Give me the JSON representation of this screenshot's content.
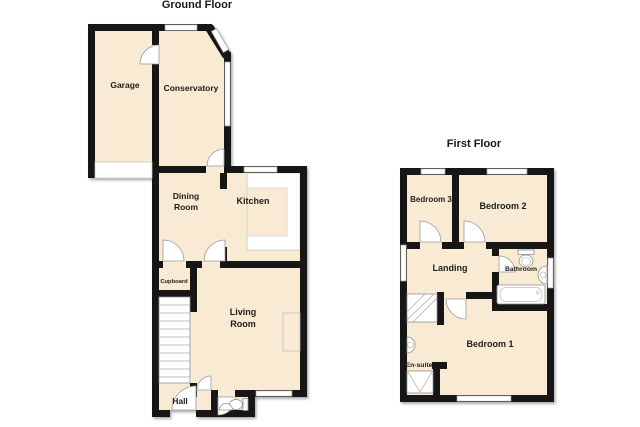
{
  "page": {
    "background": "#ffffff"
  },
  "colors": {
    "room_fill": "#f8ead3",
    "wall": "#161616",
    "window_fill": "#ffffff",
    "window_stroke": "#999999",
    "fixture_stroke": "#909090",
    "label_text": "#1d1d1d"
  },
  "ground_floor": {
    "title": "Ground Floor",
    "rooms": {
      "garage": {
        "label": "Garage"
      },
      "conservatory": {
        "label": "Conservatory"
      },
      "dining_room": {
        "line1": "Dining",
        "line2": "Room"
      },
      "kitchen": {
        "label": "Kitchen"
      },
      "cupboard": {
        "label": "Cupboard"
      },
      "living_room": {
        "line1": "Living",
        "line2": "Room"
      },
      "hall": {
        "label": "Hall"
      }
    }
  },
  "first_floor": {
    "title": "First Floor",
    "rooms": {
      "bedroom3": {
        "label": "Bedroom 3"
      },
      "bedroom2": {
        "label": "Bedroom 2"
      },
      "landing": {
        "label": "Landing"
      },
      "bathroom": {
        "label": "Bathroom"
      },
      "ensuite": {
        "label": "En-suite"
      },
      "bedroom1": {
        "label": "Bedroom 1"
      }
    }
  }
}
